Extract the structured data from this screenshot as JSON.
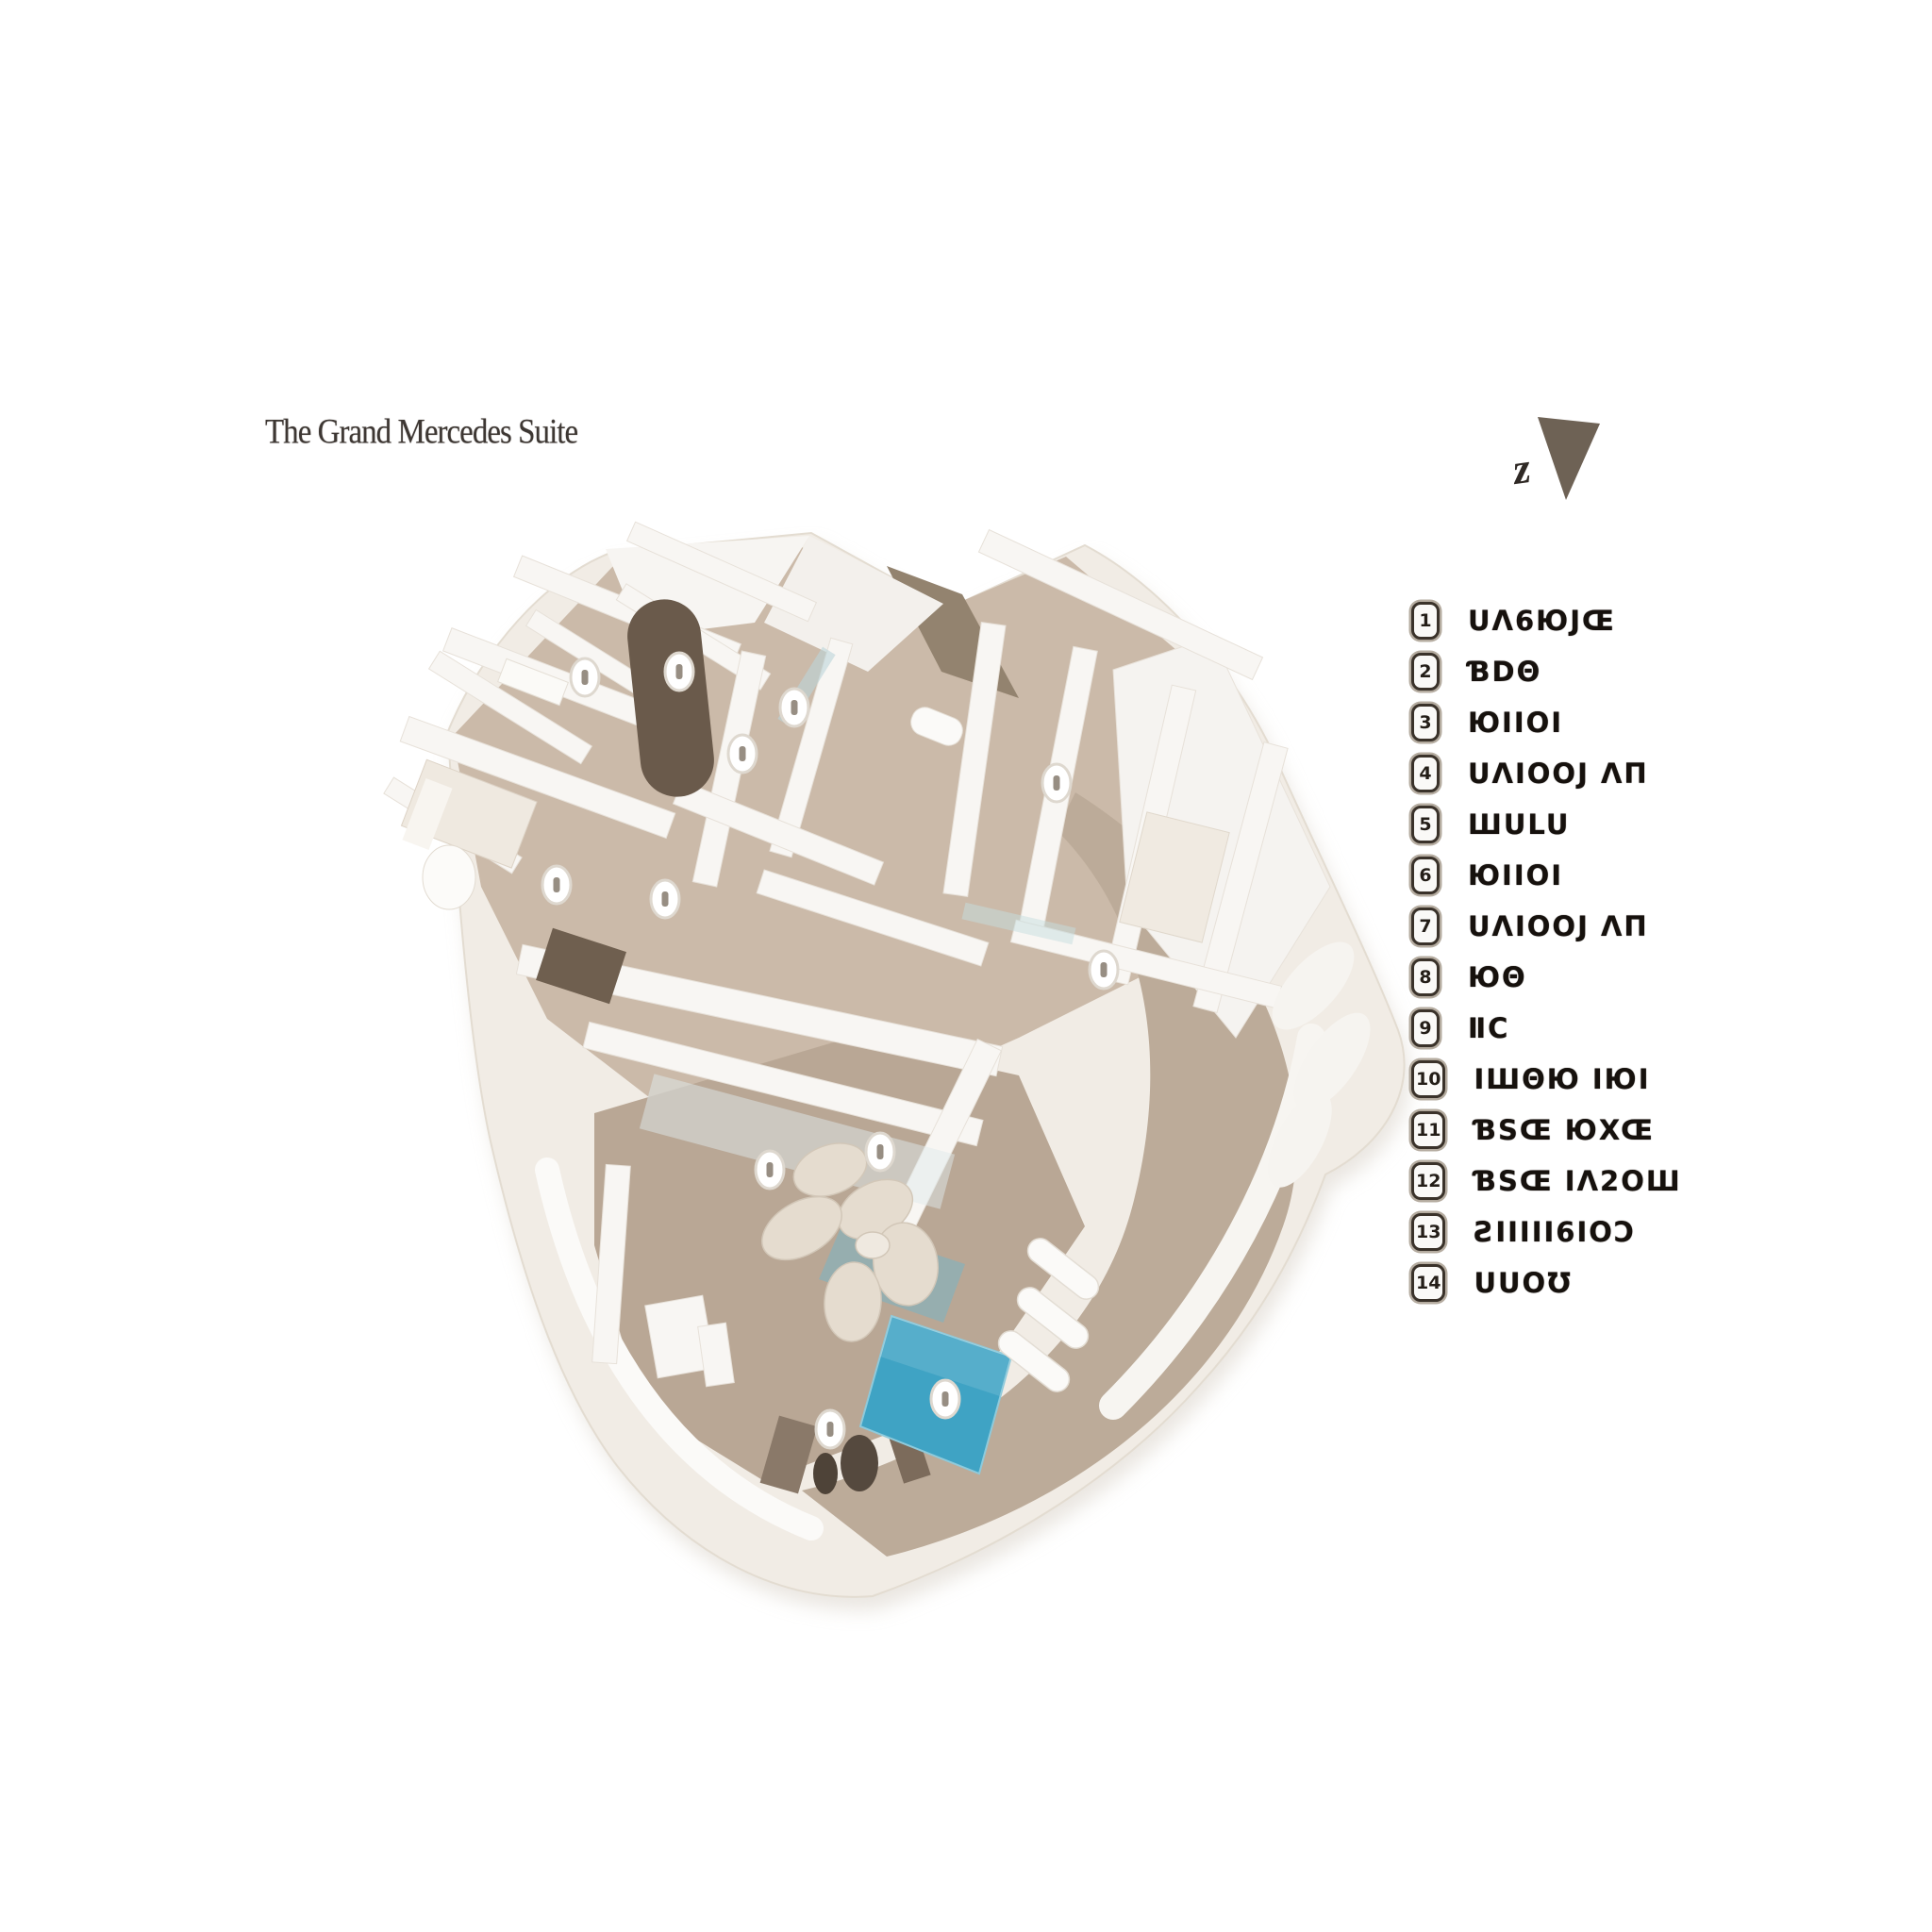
{
  "title": "The Grand Mercedes Suite",
  "north": {
    "label": "z"
  },
  "legend": {
    "items": [
      {
        "number": "1",
        "label": "UΛ6ЮJŒ"
      },
      {
        "number": "2",
        "label": "ƁDΘ"
      },
      {
        "number": "3",
        "label": "ЮIIОI"
      },
      {
        "number": "4",
        "label": "UΛIООJ ΛΠ"
      },
      {
        "number": "5",
        "label": "ШULU"
      },
      {
        "number": "6",
        "label": "ЮIIОI"
      },
      {
        "number": "7",
        "label": "UΛIООJ ΛΠ"
      },
      {
        "number": "8",
        "label": "ЮΘ"
      },
      {
        "number": "9",
        "label": "ⅡC"
      },
      {
        "number": "10",
        "label": "IШΘЮ IЮI"
      },
      {
        "number": "11",
        "label": "ƁSŒ ЮXŒ"
      },
      {
        "number": "12",
        "label": "ƁSŒ IΛ2ОШ"
      },
      {
        "number": "13",
        "label": "ƧIIIII6IОƆ"
      },
      {
        "number": "14",
        "label": "UUОƱ"
      }
    ]
  },
  "floor_plan": {
    "name": "isometric-suite-floor-plan",
    "base_color": "#f1ece5",
    "rooms_floor_color": "#cbbaa9",
    "living_floor_color": "#b9a795",
    "terrace_color": "#bcab99",
    "corridor_color": "#93836f",
    "dark_wall_color": "#6a5a4b",
    "wall_color": "#f8f6f3",
    "pool_color": "#3fa3c4"
  }
}
